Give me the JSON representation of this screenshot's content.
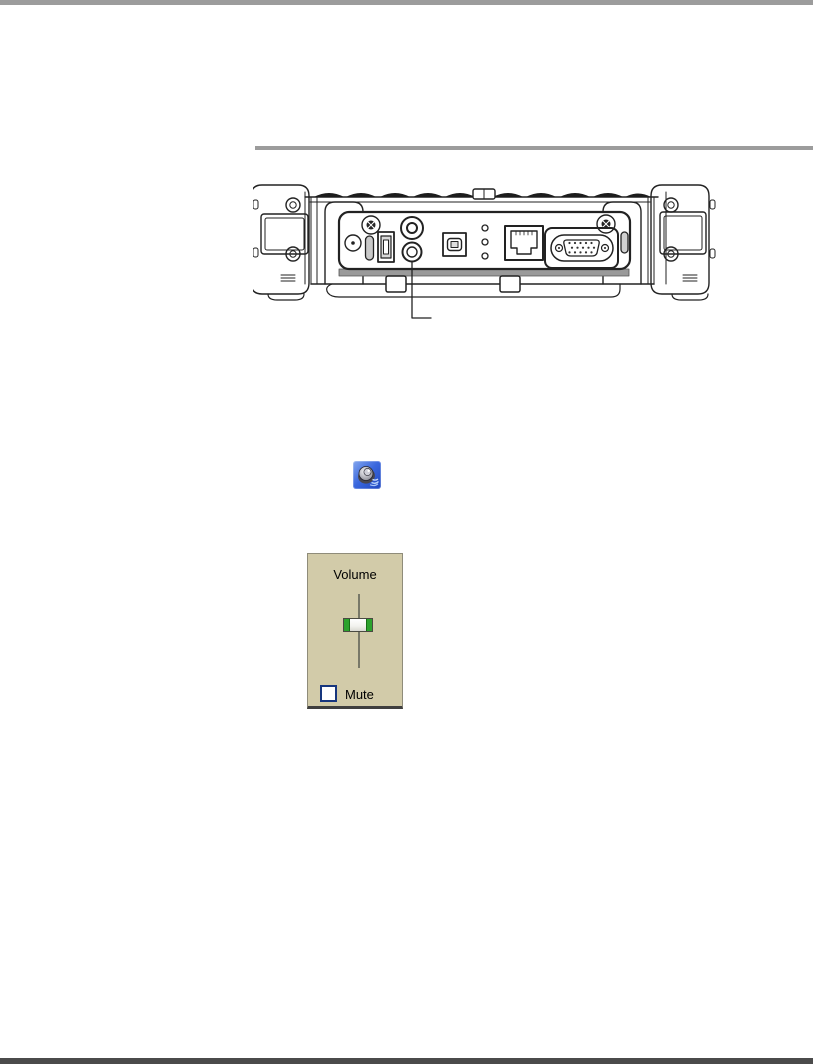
{
  "page": {
    "background": "#ffffff",
    "top_rule_color": "#9c9c9c",
    "section_rule_color": "#9c9c9c",
    "bottom_rule_color": "#4b4b4b"
  },
  "figure": {
    "kind": "line-drawing",
    "subject": "tablet-top-edge-io-ports",
    "callout_target": "audio-jack"
  },
  "tray_icon": {
    "name": "volume-speaker-icon",
    "background": "#3a67dd"
  },
  "volume_panel": {
    "title": "Volume",
    "mute_label": "Mute",
    "mute_checked": false,
    "background": "#d2cba9",
    "slider": {
      "orientation": "vertical",
      "thumb_position_from_top_pct": 43,
      "thumb_cap_color": "#2ca22c",
      "track_color": "#787868"
    }
  }
}
